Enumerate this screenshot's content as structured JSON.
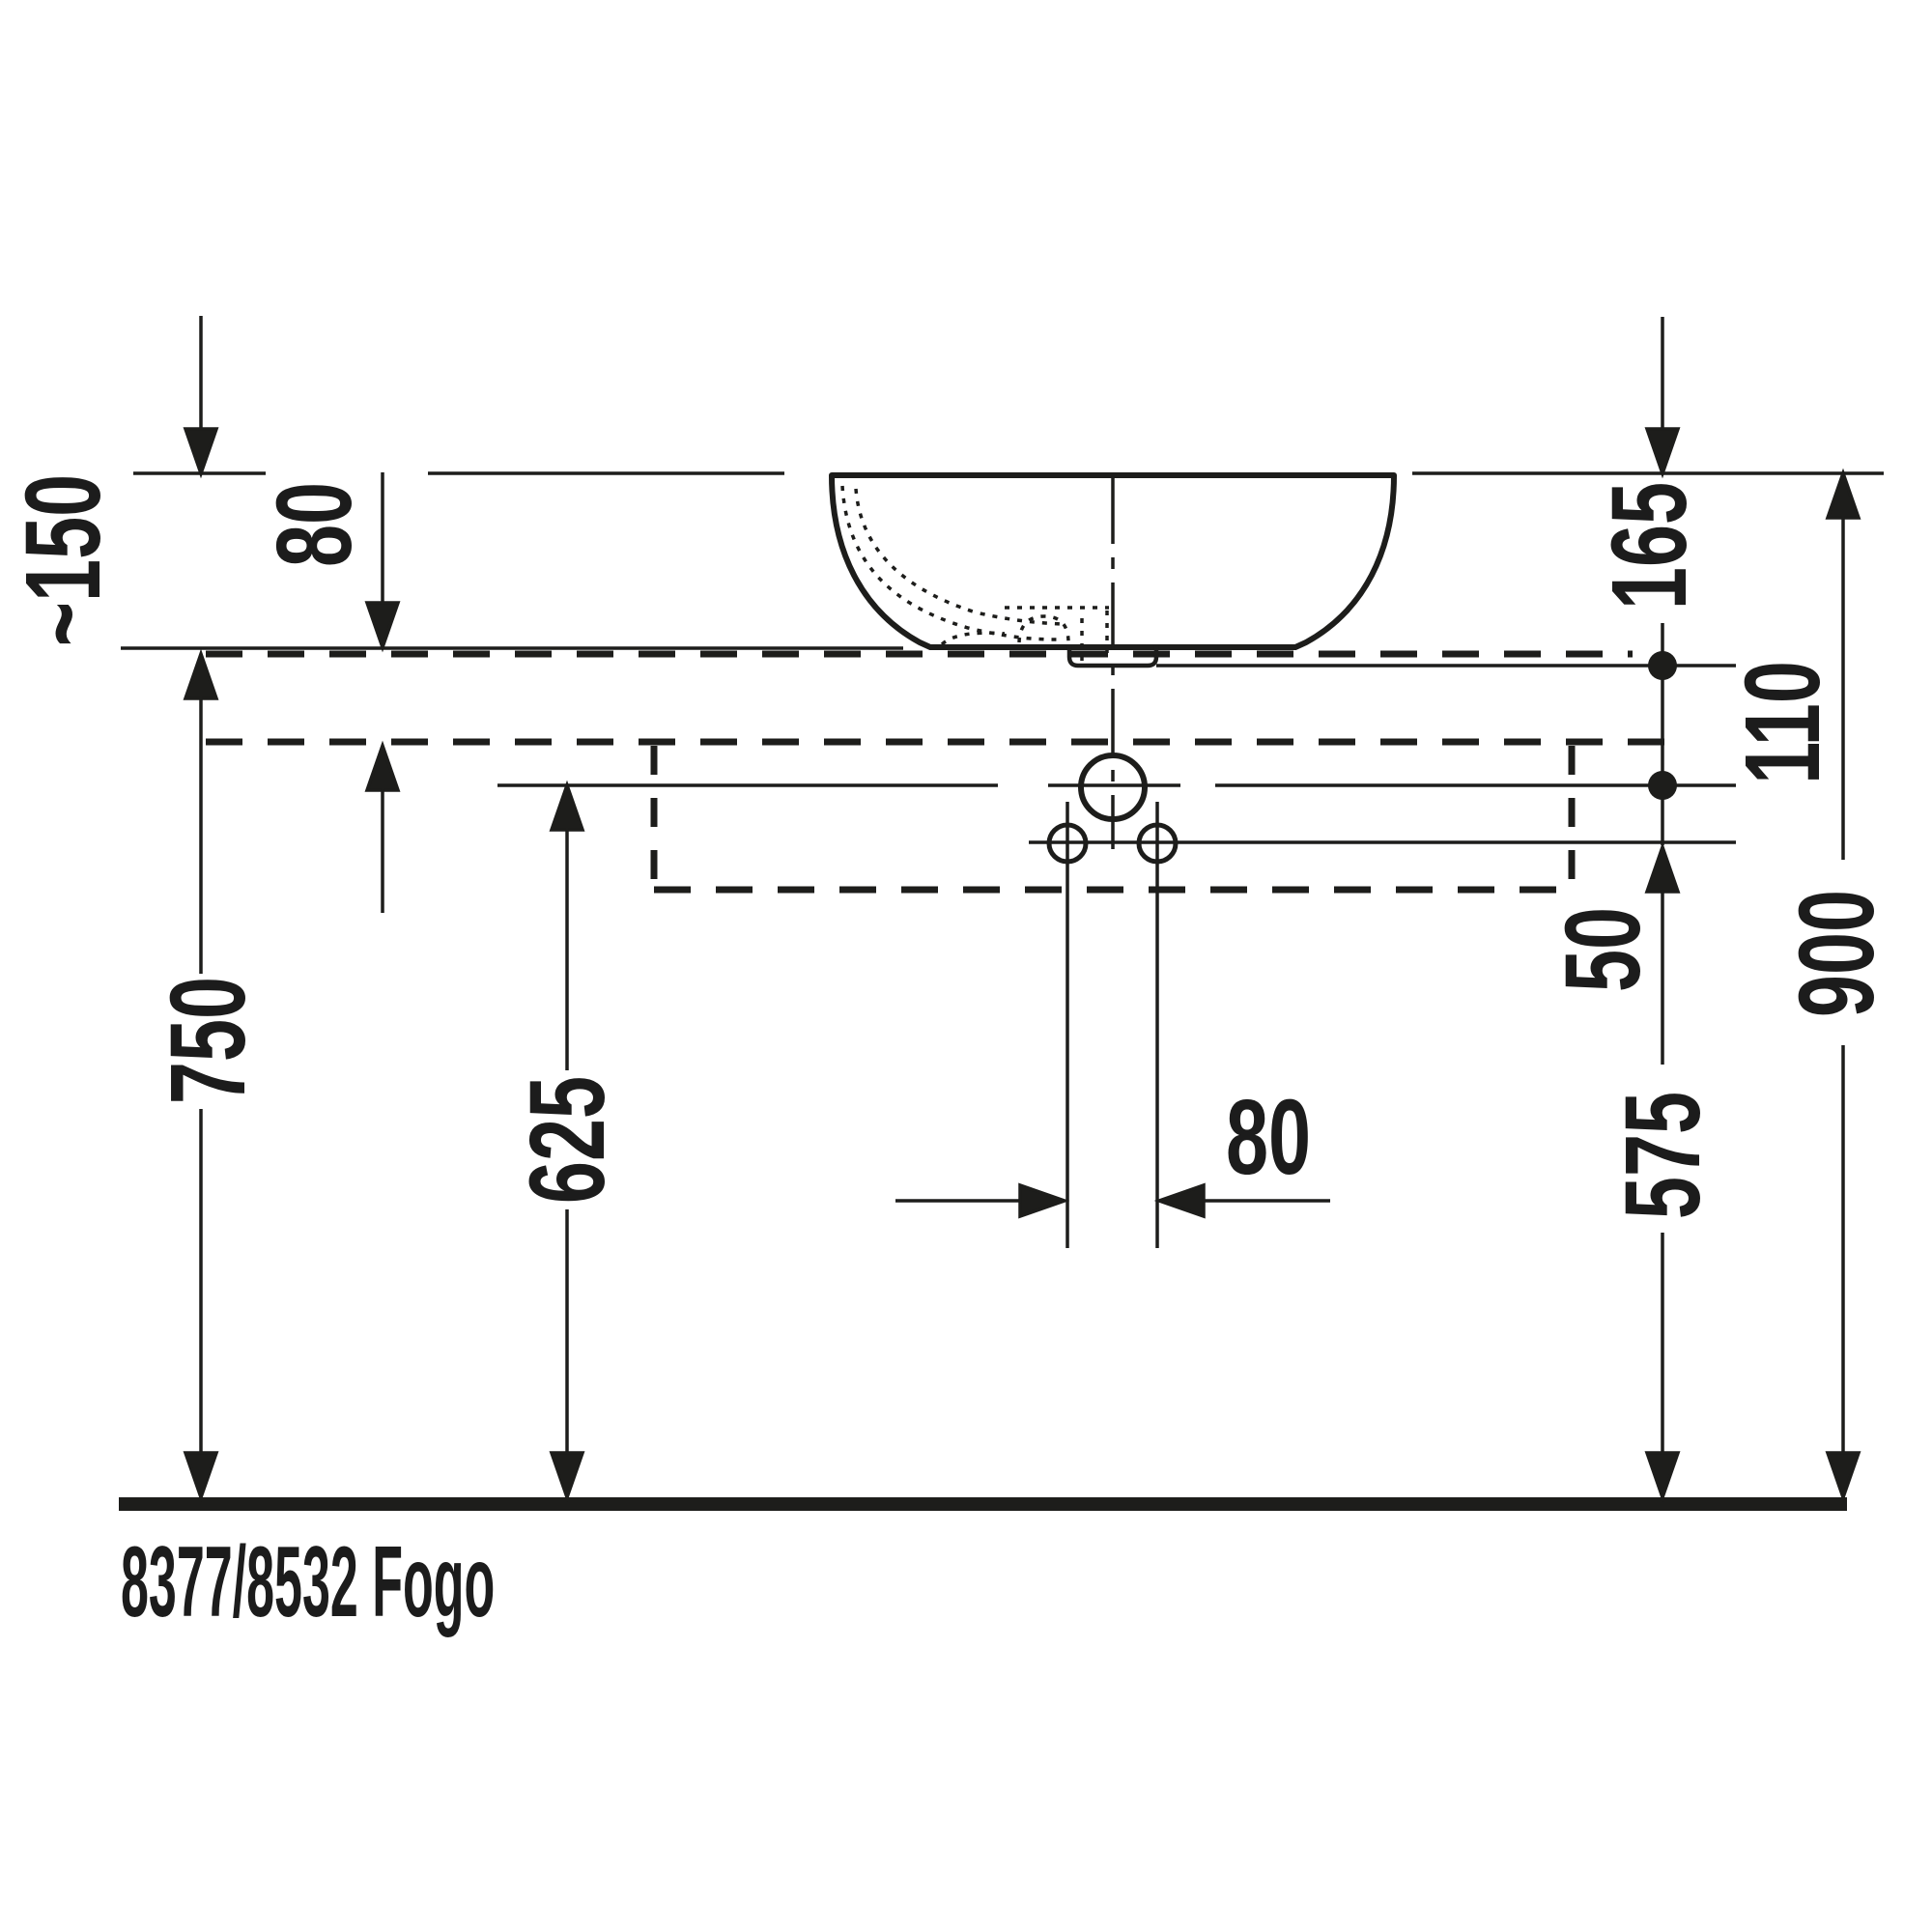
{
  "drawing": {
    "title": "8377/8532 Fogo",
    "type": "technical-dimension-drawing",
    "line_color": "#1d1d1b",
    "background": "#ffffff",
    "dims": {
      "offset150": "~150",
      "board80": "80",
      "rim165": "165",
      "holes110": "110",
      "counter750": "750",
      "level625": "625",
      "gap50": "50",
      "level575": "575",
      "rim900": "900",
      "holes80": "80"
    }
  }
}
